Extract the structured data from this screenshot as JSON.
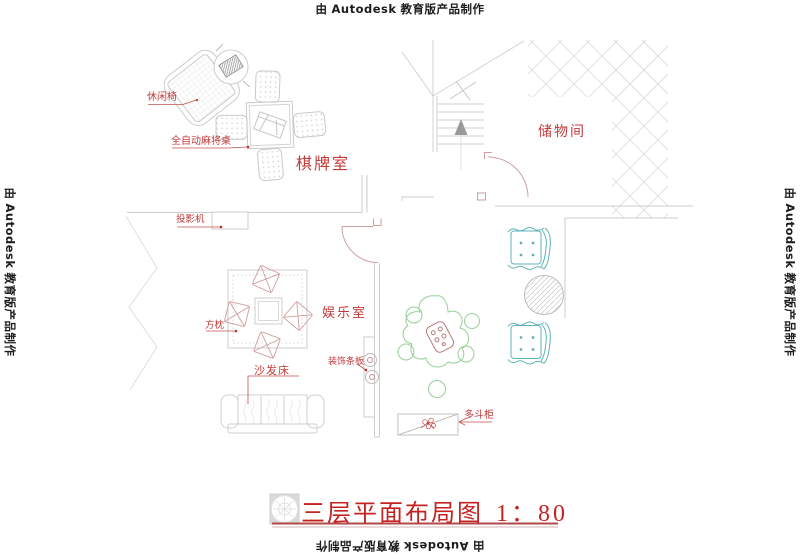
{
  "watermark": {
    "prefix": "由",
    "brand": "Autodesk",
    "suffix": "教育版产品制作"
  },
  "room_labels": {
    "chess_room": "棋牌室",
    "storage_room": "储物间",
    "entertainment_room": "娱乐室"
  },
  "furniture_labels": {
    "leisure_chair": "休闲椅",
    "mahjong_table": "全自动麻将桌",
    "projector": "投影机",
    "square_pillow": "方枕",
    "sofa_bed": "沙发床",
    "decor_panel": "装饰条板",
    "drawer_cabinet": "多斗柜"
  },
  "title_block": {
    "title": "三层平面布局图",
    "scale": "1：80"
  },
  "colors": {
    "label_red": "#c23b3b",
    "title_red": "#c52222",
    "leader_red": "#c45050",
    "line_gray": "#cdcdcd",
    "light_gray": "#dcdcdc",
    "door_pink": "#cf9e9e",
    "pillow_pink": "#cf9e9e",
    "teal": "#5fb3b8",
    "plant_green": "#97cf97",
    "arrow_gray": "#9a9a9a",
    "watermark_black": "#1c1c1c"
  }
}
